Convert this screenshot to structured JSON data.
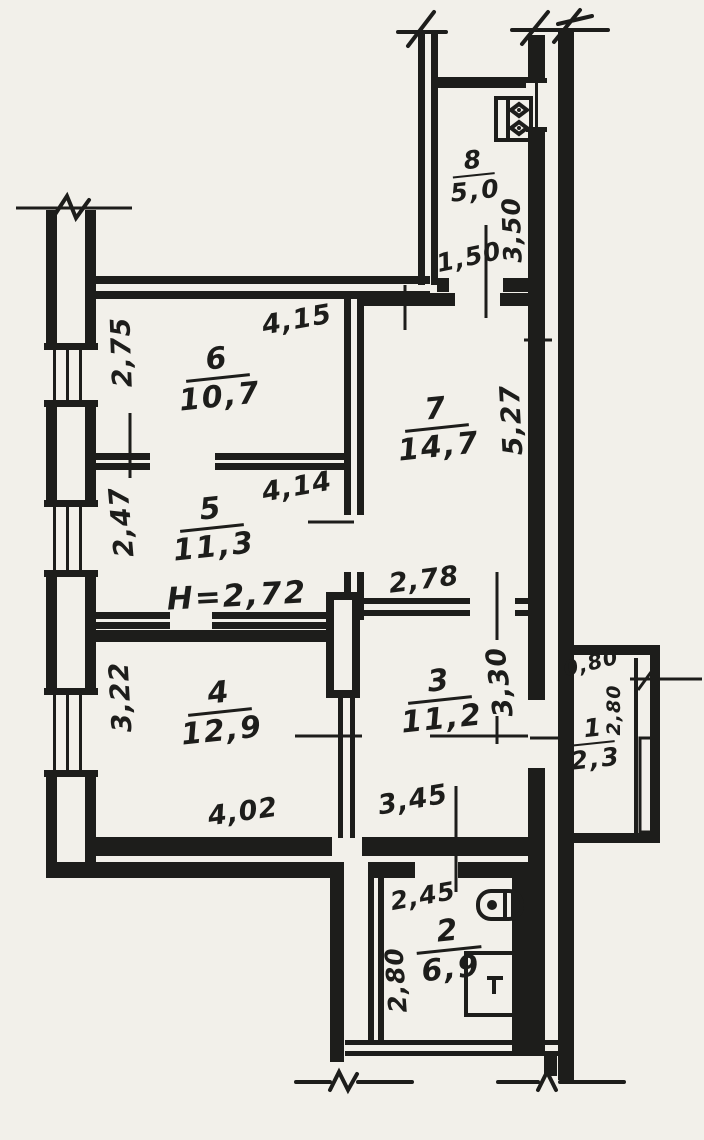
{
  "plan": {
    "note": "H=2,72",
    "rooms": {
      "r1": {
        "number": "1",
        "area": "2,3",
        "width": "0,80",
        "height": "2,80"
      },
      "r2": {
        "number": "2",
        "area": "6,9",
        "width": "2,45",
        "height": "2,80"
      },
      "r3": {
        "number": "3",
        "area": "11,2",
        "width": "3,45",
        "height": "3,30"
      },
      "r4": {
        "number": "4",
        "area": "12,9",
        "width": "4,02",
        "height": "3,22"
      },
      "r5": {
        "number": "5",
        "area": "11,3",
        "width": "4,14",
        "height": "2,47"
      },
      "r6": {
        "number": "6",
        "area": "10,7",
        "width": "4,15",
        "height": "2,75"
      },
      "r7": {
        "number": "7",
        "area": "14,7",
        "width": "2,78",
        "height": "5,27"
      },
      "r8": {
        "number": "8",
        "area": "5,0",
        "width": "1,50",
        "height": "3,50"
      }
    },
    "colors": {
      "ink": "#1d1d1b",
      "paper": "#f2f0ea"
    },
    "fixtures": {
      "room8": "stove-icon",
      "room2_top": "boiler-icon",
      "room2_bottom": "stove-icon"
    }
  }
}
